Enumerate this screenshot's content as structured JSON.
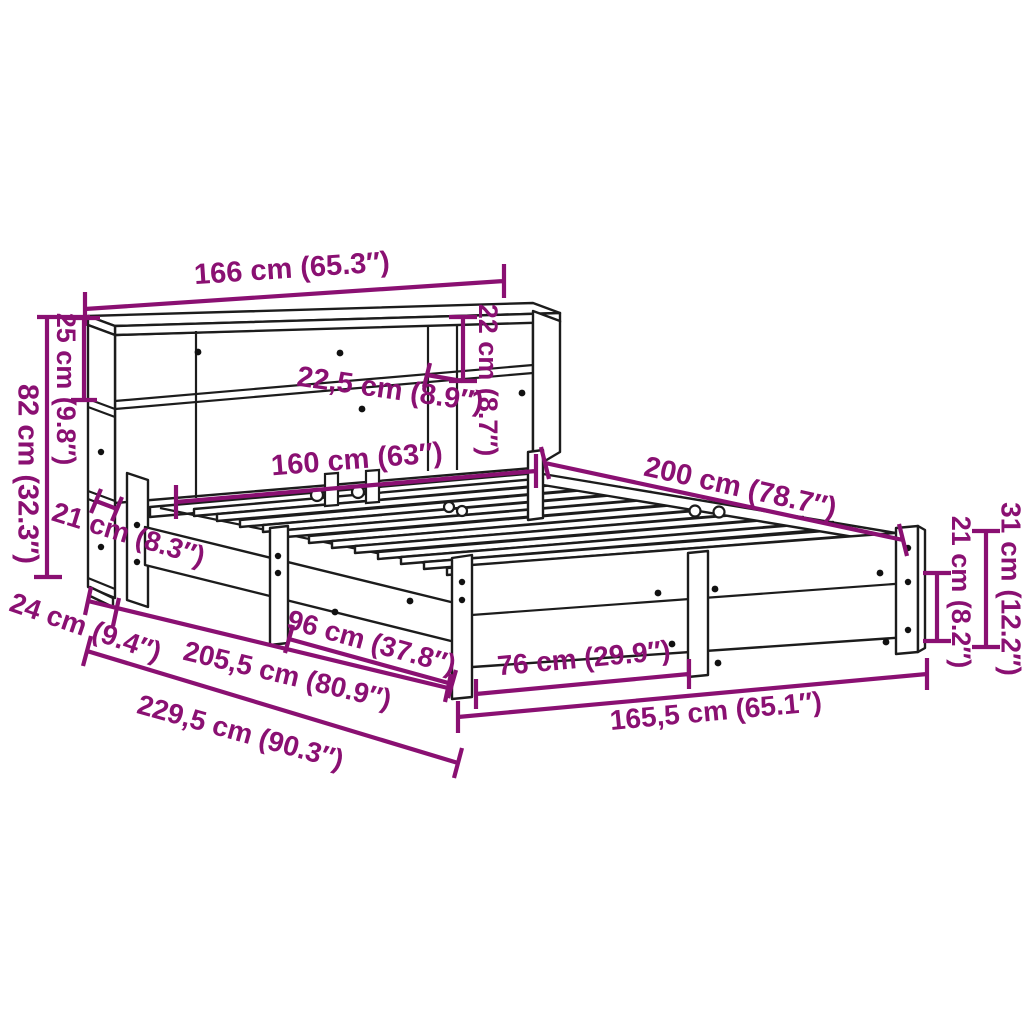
{
  "colors": {
    "dimension_accent": "#8a1072",
    "outline": "#1c1c1c",
    "background": "#ffffff"
  },
  "dimensions": {
    "headboard_width": "166 cm (65.3″)",
    "upper_shelf_height": "25 cm (9.8″)",
    "headboard_height": "82 cm (32.3″)",
    "upper_shelf_depth": "22,5 cm (8.9″)",
    "shelf_opening_height": "22 cm (8.7″)",
    "slat_area_width": "160 cm (63″)",
    "bed_length": "200 cm (78.7″)",
    "lower_shelf_depth": "21 cm (8.3″)",
    "headboard_depth": "24 cm (9.4″)",
    "frame_length": "205,5 cm (80.9″)",
    "total_length": "229,5 cm (90.3″)",
    "side_leg_span": "96 cm (37.8″)",
    "foot_leg_span": "76 cm (29.9″)",
    "frame_width": "165,5 cm (65.1″)",
    "underbed_height": "21 cm (8.2″)",
    "frame_height": "31 cm (12.2″)"
  }
}
